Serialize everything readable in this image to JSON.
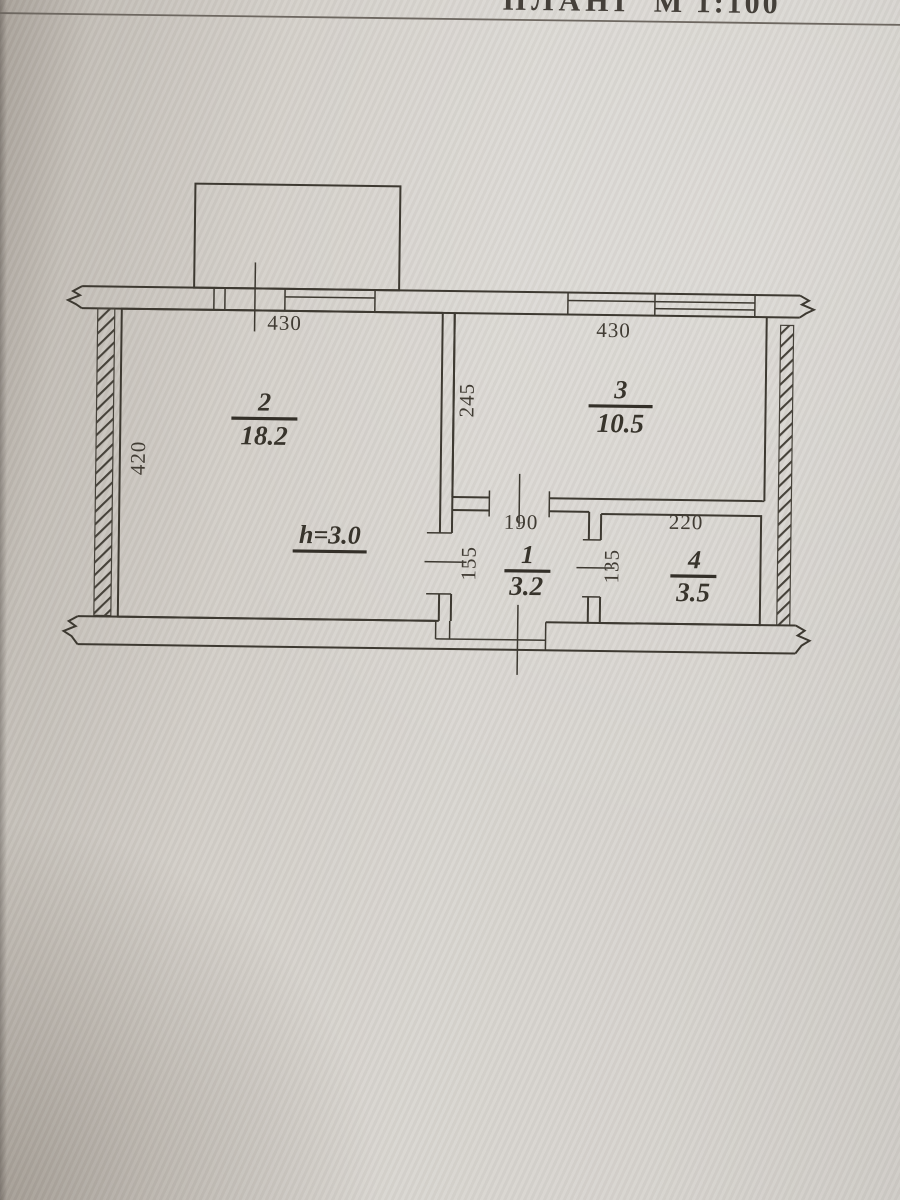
{
  "header": {
    "title_fragment": "ПЛАНІ",
    "scale": "М 1:100"
  },
  "plan": {
    "type": "apartment-floor-plan",
    "rooms": [
      {
        "number": "2",
        "area": "18.2",
        "width_dim": "430",
        "height_dim": "420",
        "height_note": "h=3.0"
      },
      {
        "number": "3",
        "area": "10.5",
        "width_dim": "430",
        "height_dim": "245"
      },
      {
        "number": "1",
        "area": "3.2",
        "width_dim": "190",
        "height_dim": "155"
      },
      {
        "number": "4",
        "area": "3.5",
        "width_dim": "220",
        "height_dim": "135"
      }
    ],
    "colors": {
      "ink": "#3d3931",
      "paper": "#d5d1cb"
    }
  }
}
